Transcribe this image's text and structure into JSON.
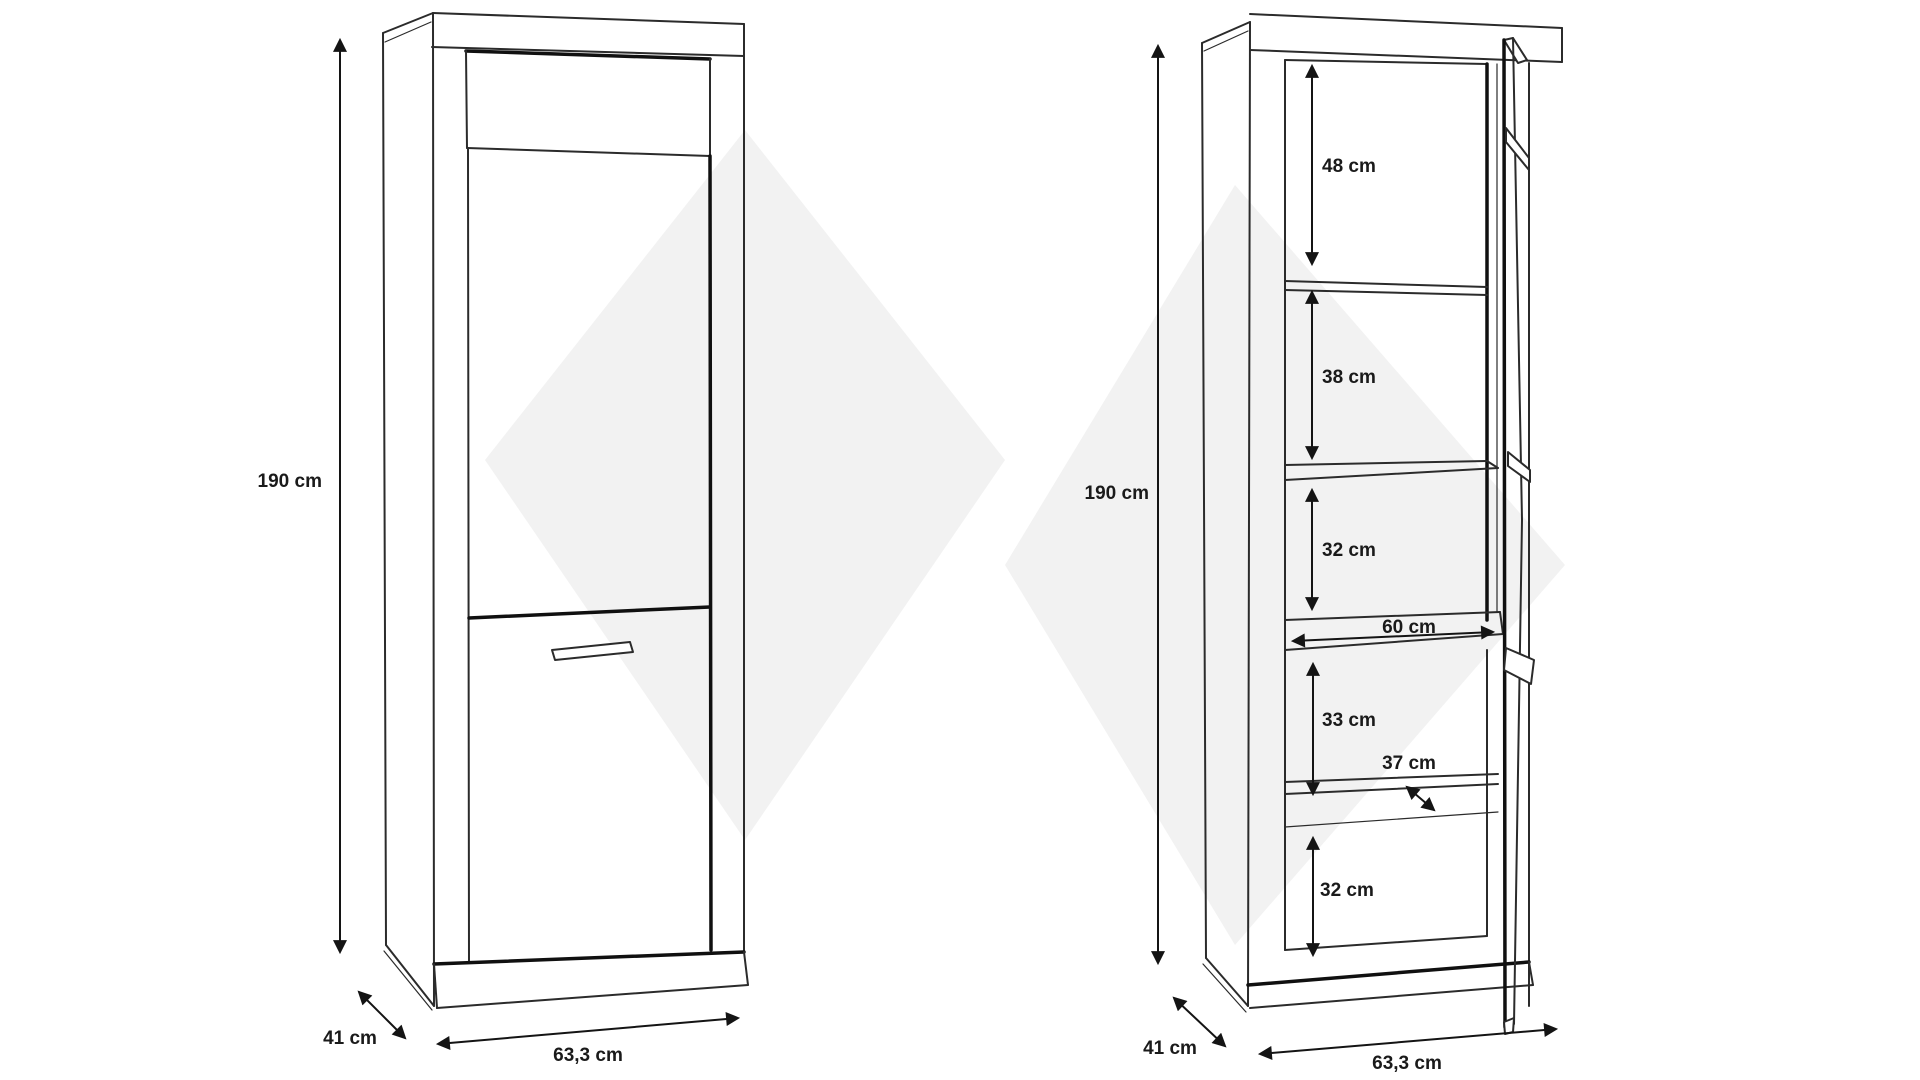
{
  "diagram": {
    "type": "furniture-dimension-drawing",
    "unit": "cm",
    "watermark_color": "#f2f2f2",
    "line_color": "#2b2b2b"
  },
  "front_view": {
    "height_label": "190 cm",
    "depth_label": "41 cm",
    "width_label": "63,3 cm"
  },
  "open_view": {
    "height_label": "190 cm",
    "depth_label": "41 cm",
    "width_label": "63,3 cm",
    "compartment_heights": [
      "48 cm",
      "38 cm",
      "32 cm",
      "33 cm",
      "32 cm"
    ],
    "shelf_width_label": "60 cm",
    "shelf_depth_label": "37 cm"
  },
  "diagram_data": {
    "overall": {
      "height_cm": 190,
      "width_cm": 63.3,
      "depth_cm": 41
    },
    "interior_compartments_top_to_bottom_cm": [
      48,
      38,
      32,
      33,
      32
    ],
    "shelf_width_cm": 60,
    "shelf_depth_cm": 37
  }
}
